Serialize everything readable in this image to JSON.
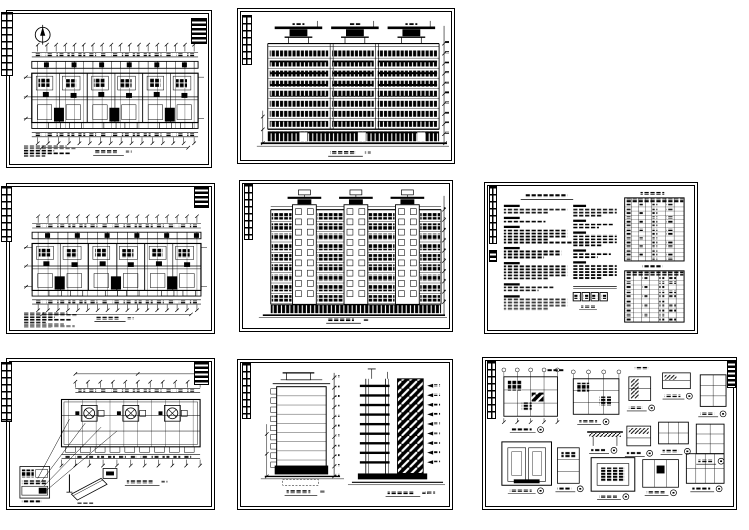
{
  "palette": {
    "paper": "#ffffff",
    "ink": "#000000"
  },
  "figure": {
    "panels": 8,
    "rows": 3,
    "panels_per_row": [
      2,
      3,
      3
    ]
  },
  "sheets": [
    {
      "name": "ground-floor-plan-sheet",
      "kind": "plan",
      "axis_ticks_top": 18,
      "axis_ticks_bottom": 16,
      "units": 3,
      "note_lines": 5,
      "has_north_arrow": true
    },
    {
      "name": "front-elevation-sheet",
      "kind": "elev_front",
      "floors": 8,
      "bays": 3,
      "roof_caps": 3
    },
    {
      "name": "standard-floor-plan-sheet",
      "kind": "plan",
      "axis_ticks_top": 17,
      "axis_ticks_bottom": 17,
      "units": 3,
      "note_lines": 8,
      "has_north_arrow": false
    },
    {
      "name": "rear-elevation-sheet",
      "kind": "elev_rear",
      "floors": 9,
      "stair_towers": 3
    },
    {
      "name": "design-notes-and-schedules-sheet",
      "kind": "notes",
      "text_columns": 2,
      "schedule_tables": 2,
      "stamp_boxes": 4
    },
    {
      "name": "roof-plan-sheet",
      "kind": "roof",
      "roof_vents": 3,
      "leader_lines": 4
    },
    {
      "name": "side-elevation-and-section-sheet",
      "kind": "side_section",
      "floors": 9
    },
    {
      "name": "construction-details-sheet",
      "kind": "details",
      "details": 14
    }
  ]
}
